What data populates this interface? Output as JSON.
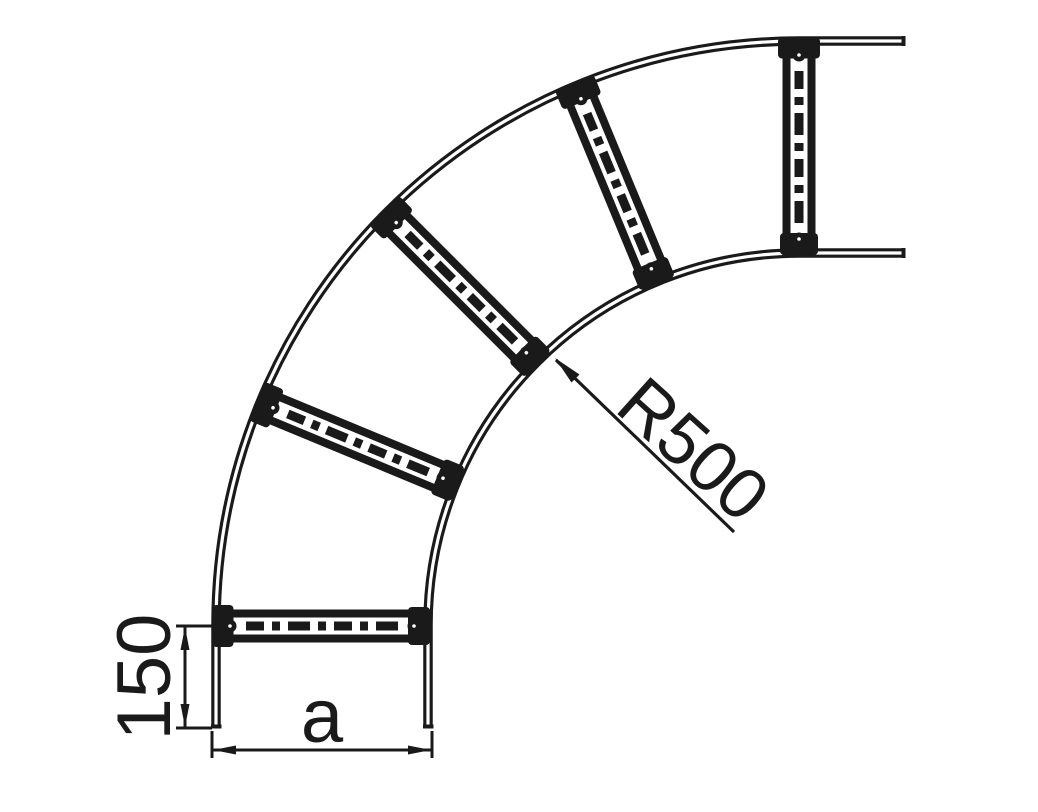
{
  "page": {
    "background": "#ffffff",
    "ink_color": "#1a1a1a",
    "description": "Technical drawing of a 90 degree cable ladder bend (plan view) with five perforated rungs"
  },
  "annotations": {
    "bend_radius": {
      "label": "R500"
    },
    "end_tangent_length": {
      "label": "150"
    },
    "ladder_width": {
      "label": "a"
    }
  }
}
